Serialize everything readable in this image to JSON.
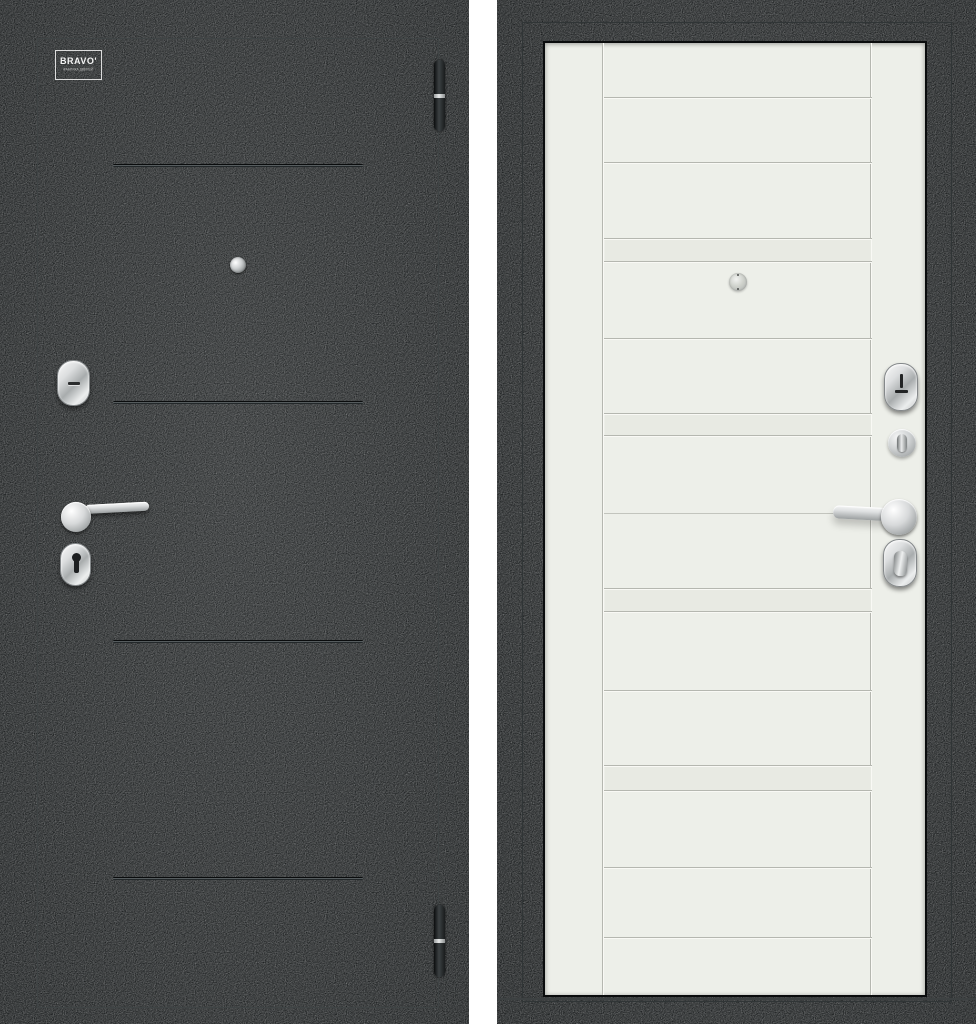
{
  "logo": {
    "brand": "BRAVO'",
    "tagline": "ФАБРИКА ДВЕРЕЙ"
  },
  "colors": {
    "background": "#ffffff",
    "exterior_finish": "#1b1e1f",
    "interior_frame": "#1a1d1e",
    "interior_leaf": "#edefe9",
    "groove_shadow": "#b5b7b0",
    "hardware_chrome": "#d8dadb"
  }
}
